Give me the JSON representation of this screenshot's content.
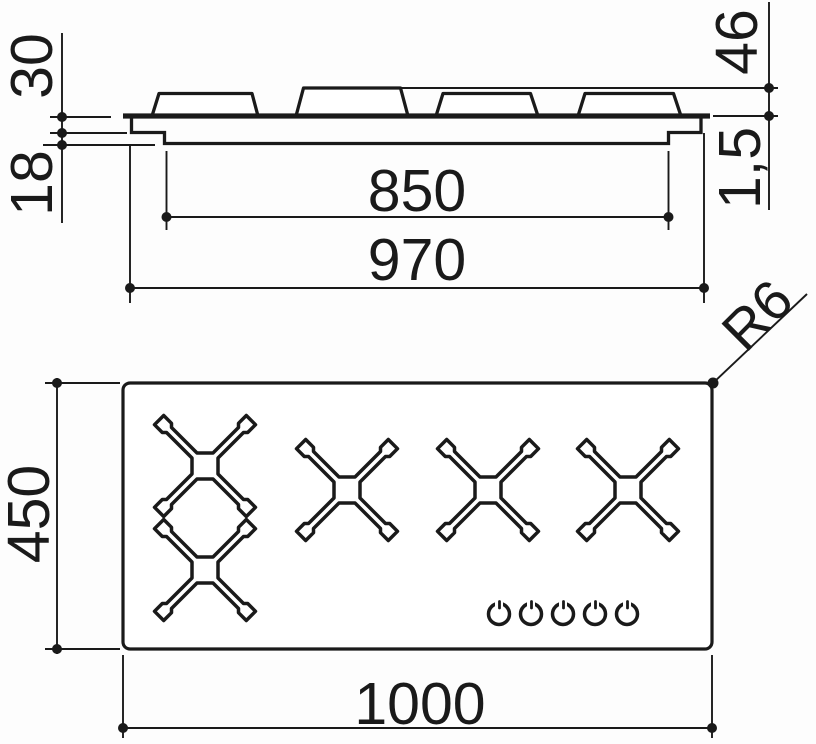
{
  "colors": {
    "line": "#1a1a1a",
    "background": "#fdfdfd"
  },
  "profile_view": {
    "description": "side section of hob",
    "burner_cap_count": 4,
    "dims": {
      "cap_height_above_top": "30",
      "body_depth_below_top": "18",
      "total_height": "46",
      "top_plate_thickness": "1,5",
      "body_width": "850",
      "flange_width": "970"
    }
  },
  "plan_view": {
    "description": "top view of hob",
    "pan_support_count": 4,
    "control_knob_count": 5,
    "dims": {
      "depth": "450",
      "width": "1000",
      "corner_radius": "R6"
    }
  }
}
